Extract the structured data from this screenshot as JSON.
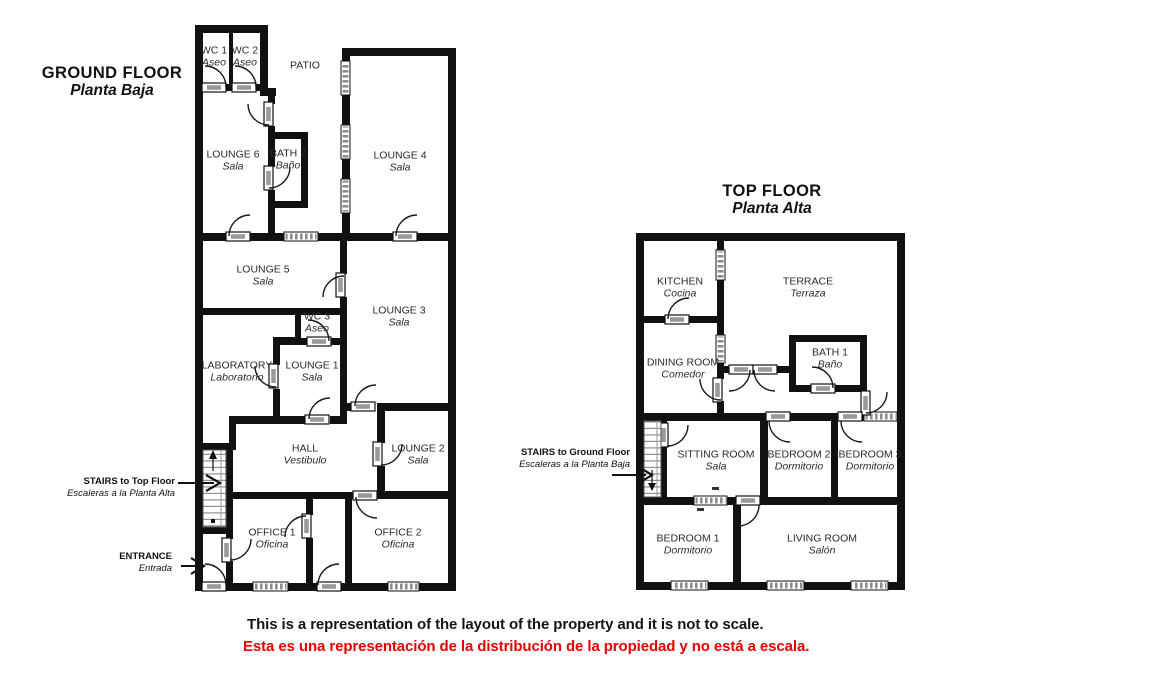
{
  "ground": {
    "title": "GROUND FLOOR",
    "subtitle": "Planta Baja",
    "rooms": [
      {
        "name": "WC 1",
        "name_es": "Aseo"
      },
      {
        "name": "WC 2",
        "name_es": "Aseo"
      },
      {
        "name": "PATIO",
        "name_es": ""
      },
      {
        "name": "LOUNGE 6",
        "name_es": "Sala"
      },
      {
        "name": "BATH 2",
        "name_es": "Baño"
      },
      {
        "name": "LOUNGE 4",
        "name_es": "Sala"
      },
      {
        "name": "LOUNGE 5",
        "name_es": "Sala"
      },
      {
        "name": "LOUNGE 3",
        "name_es": "Sala"
      },
      {
        "name": "WC 3",
        "name_es": "Aseo"
      },
      {
        "name": "LABORATORY",
        "name_es": "Laboratorio"
      },
      {
        "name": "LOUNGE 1",
        "name_es": "Sala"
      },
      {
        "name": "HALL",
        "name_es": "Vestibulo"
      },
      {
        "name": "LOUNGE 2",
        "name_es": "Sala"
      },
      {
        "name": "OFFICE 1",
        "name_es": "Oficina"
      },
      {
        "name": "OFFICE 2",
        "name_es": "Oficina"
      }
    ],
    "annotations": [
      {
        "line1": "STAIRS to Top Floor",
        "line2": "Escaleras a la Planta Alta"
      },
      {
        "line1": "ENTRANCE",
        "line2": "Entrada"
      }
    ]
  },
  "top": {
    "title": "TOP FLOOR",
    "subtitle": "Planta Alta",
    "rooms": [
      {
        "name": "KITCHEN",
        "name_es": "Cocina"
      },
      {
        "name": "TERRACE",
        "name_es": "Terraza"
      },
      {
        "name": "DINING ROOM",
        "name_es": "Comedor"
      },
      {
        "name": "BATH 1",
        "name_es": "Baño"
      },
      {
        "name": "SITTING ROOM",
        "name_es": "Sala"
      },
      {
        "name": "BEDROOM 2",
        "name_es": "Dormitorio"
      },
      {
        "name": "BEDROOM 3",
        "name_es": "Dormitorio"
      },
      {
        "name": "BEDROOM 1",
        "name_es": "Dormitorio"
      },
      {
        "name": "LIVING ROOM",
        "name_es": "Salón"
      }
    ],
    "annotations": [
      {
        "line1": "STAIRS to Ground Floor",
        "line2": "Escaleras a la Planta Baja"
      }
    ]
  },
  "footer": {
    "line1": "This is a representation of the layout of the property and it is not to scale.",
    "line2": "Esta es una representación de la distribución de la propiedad y no está a escala."
  },
  "colors": {
    "wall": "#111111",
    "text": "#2a2a2a",
    "footer_red": "#e60000",
    "window_gray": "#8d8d8d"
  }
}
